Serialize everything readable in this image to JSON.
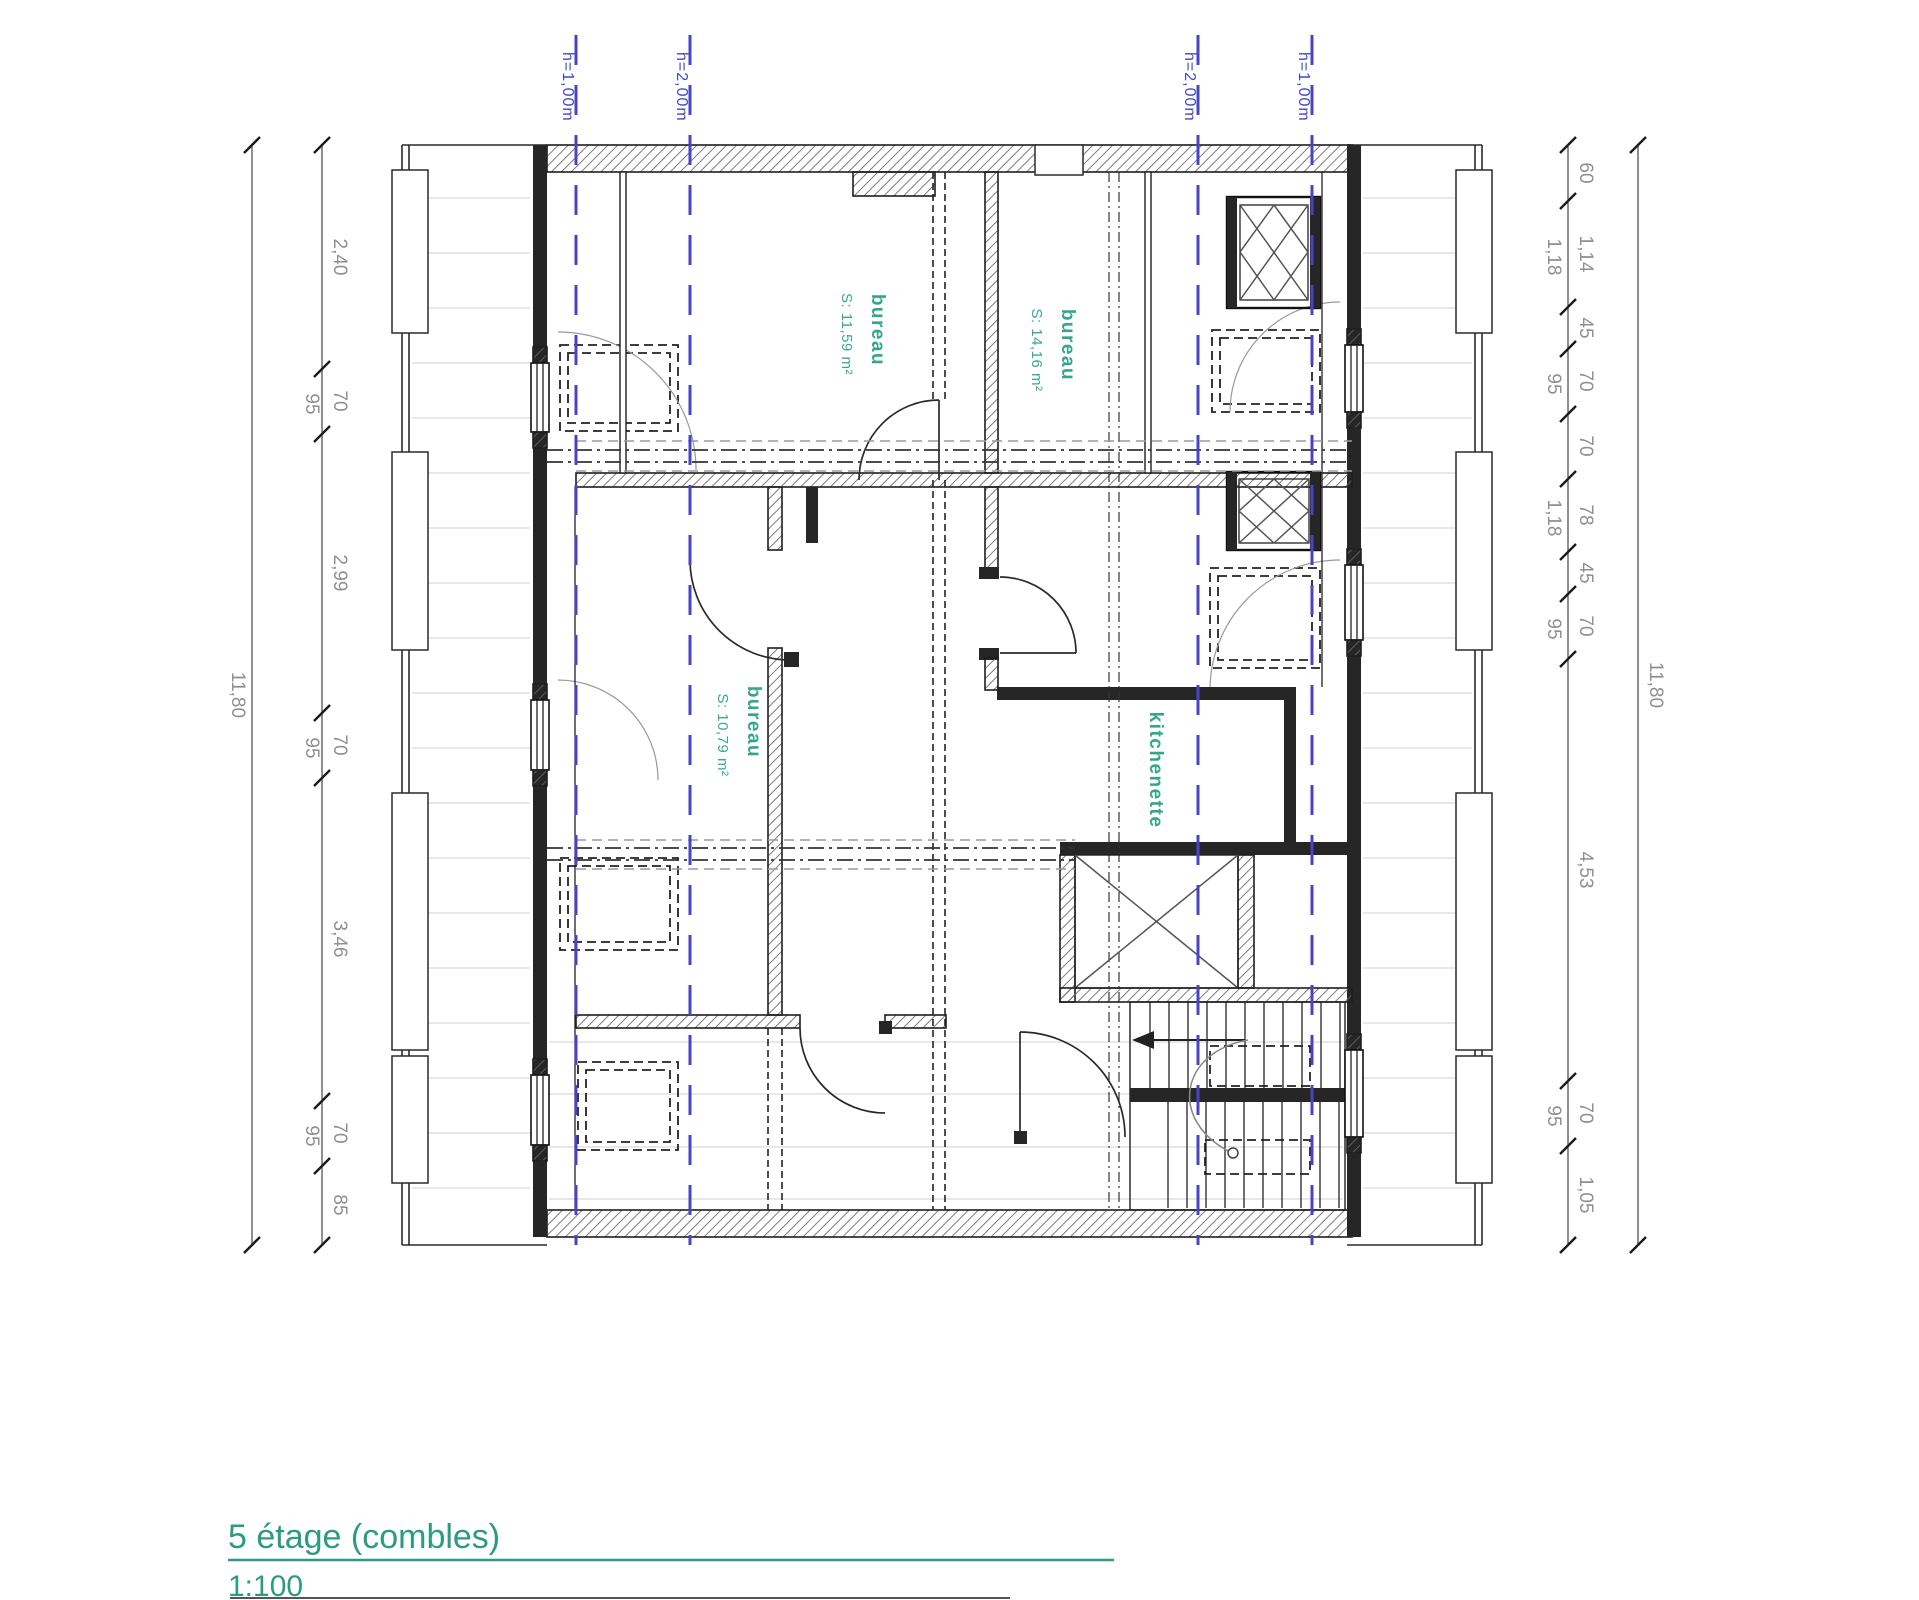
{
  "drawing": {
    "floor_label": "5 étage (combles)",
    "scale_label": "1:100"
  },
  "colors": {
    "accent_teal": "#2d9b80",
    "room_label_teal": "#35a68e",
    "height_line_blue": "#4646c2",
    "dimension_gray": "#8f8f8f",
    "wall_dark": "#262626"
  },
  "height_lines": [
    {
      "label": "h=1,00m"
    },
    {
      "label": "h=2,00m"
    },
    {
      "label": "h=2,00m"
    },
    {
      "label": "h=1,00m"
    }
  ],
  "rooms": [
    {
      "name": "bureau",
      "area": "S: 11,59 m²"
    },
    {
      "name": "bureau",
      "area": "S: 14,16 m²"
    },
    {
      "name": "bureau",
      "area": "S: 10,79 m²"
    },
    {
      "name": "kitchenette",
      "area": ""
    }
  ],
  "dimensions": {
    "left": {
      "total": "11,80",
      "segments": [
        "2,40",
        "70",
        "95",
        "2,99",
        "70",
        "95",
        "3,46",
        "70",
        "95",
        "85"
      ]
    },
    "right": {
      "total": "11,80",
      "segments": [
        "60",
        "1,14",
        "1,18",
        "45",
        "70",
        "95",
        "70",
        "78",
        "1,18",
        "45",
        "70",
        "95",
        "4,53",
        "70",
        "95",
        "1,05"
      ]
    }
  }
}
